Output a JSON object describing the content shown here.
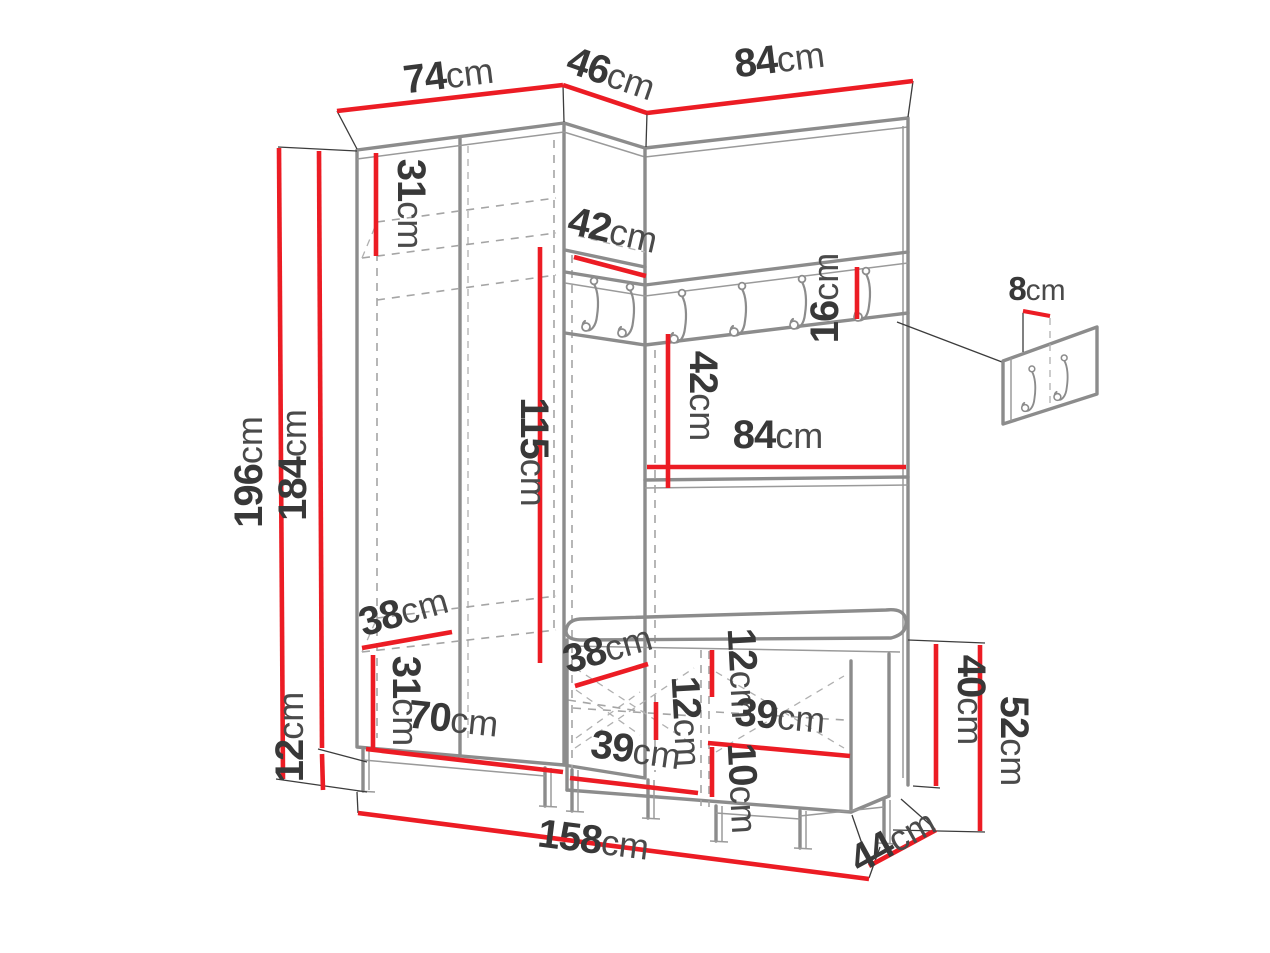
{
  "meta": {
    "drawing_type": "furniture dimension diagram",
    "unit": "cm",
    "colors": {
      "dimension_red": "#ec1c24",
      "outline_gray": "#8c8c8c",
      "text_dark": "#383838",
      "background": "#ffffff"
    }
  },
  "hook_rail": {
    "hooks_front_count": 4,
    "hooks_corner_count": 2
  },
  "detail_callout": {
    "hooks_count": 2
  },
  "dimensions": {
    "top_width_left": {
      "num": "74",
      "unit": "cm"
    },
    "top_width_corner": {
      "num": "46",
      "unit": "cm"
    },
    "top_width_right": {
      "num": "84",
      "unit": "cm"
    },
    "total_height": {
      "num": "196",
      "unit": "cm"
    },
    "carcass_height": {
      "num": "184",
      "unit": "cm"
    },
    "top_shelf_height": {
      "num": "31",
      "unit": "cm"
    },
    "corner_shelf_depth": {
      "num": "42",
      "unit": "cm"
    },
    "hanging_height": {
      "num": "115",
      "unit": "cm"
    },
    "rail_board_height": {
      "num": "16",
      "unit": "cm"
    },
    "panel_gap_height": {
      "num": "42",
      "unit": "cm"
    },
    "panel_width": {
      "num": "84",
      "unit": "cm"
    },
    "detail_offset": {
      "num": "8",
      "unit": "cm"
    },
    "wardrobe_shelf_depth": {
      "num": "38",
      "unit": "cm"
    },
    "bottom_shelf_height": {
      "num": "31",
      "unit": "cm"
    },
    "plinth_height": {
      "num": "12",
      "unit": "cm"
    },
    "wardrobe_inner_width": {
      "num": "70",
      "unit": "cm"
    },
    "bench_depth": {
      "num": "38",
      "unit": "cm"
    },
    "bench_top_gap": {
      "num": "12",
      "unit": "cm"
    },
    "corner_comp_height": {
      "num": "12",
      "unit": "cm"
    },
    "bench_inner_width": {
      "num": "39",
      "unit": "cm"
    },
    "corner_bottom_width": {
      "num": "39",
      "unit": "cm"
    },
    "bench_leg_height": {
      "num": "10",
      "unit": "cm"
    },
    "bench_box_height": {
      "num": "40",
      "unit": "cm"
    },
    "bench_total_height": {
      "num": "52",
      "unit": "cm"
    },
    "bench_floor_depth": {
      "num": "44",
      "unit": "cm"
    },
    "total_width": {
      "num": "158",
      "unit": "cm"
    }
  }
}
